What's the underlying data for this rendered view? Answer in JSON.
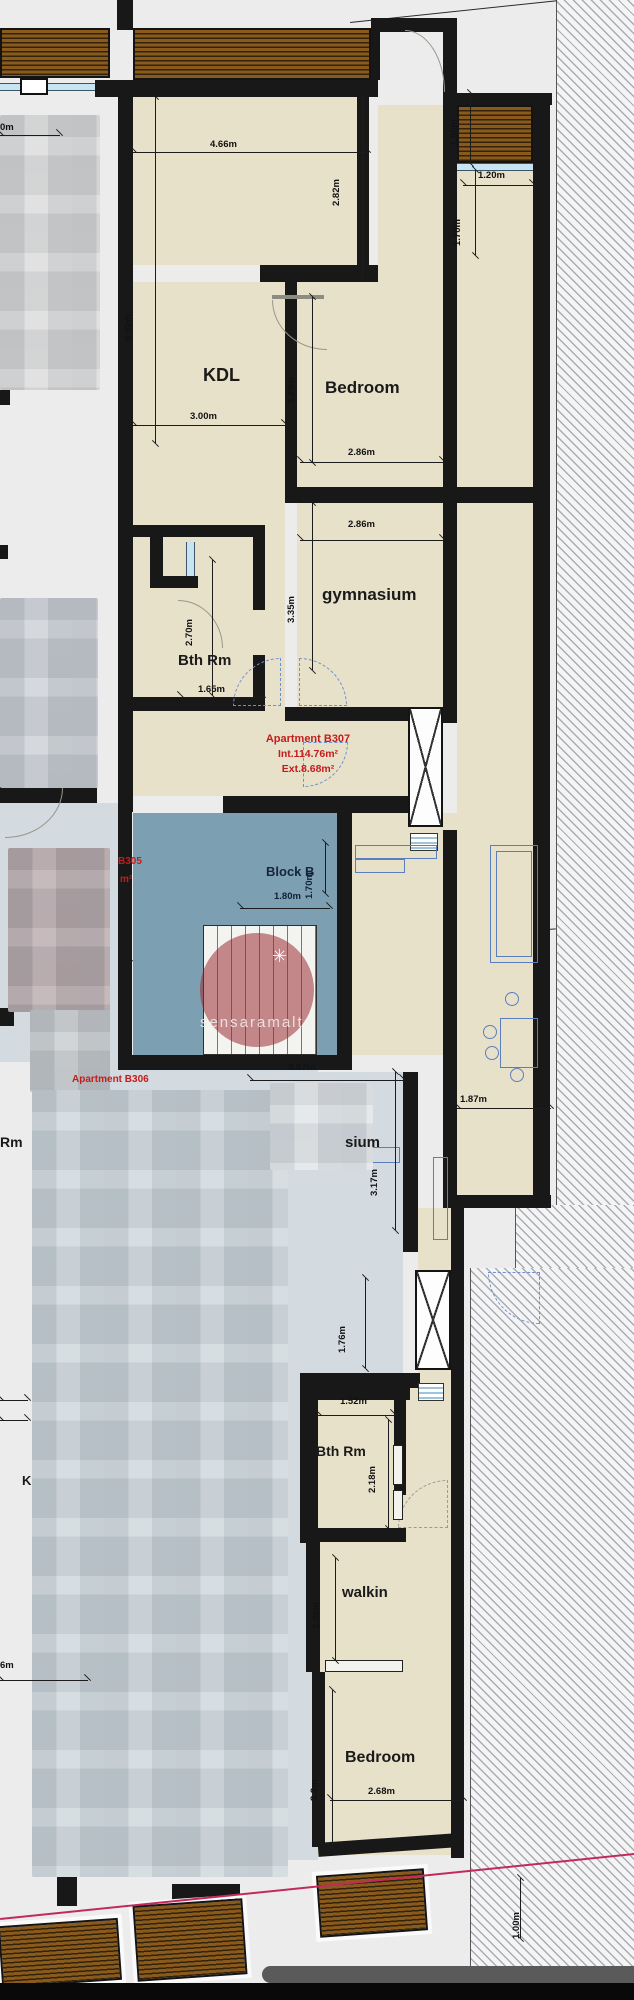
{
  "watermark": {
    "text": "sensaramalta"
  },
  "icons": {
    "watermark_star": "✳"
  },
  "rooms": {
    "kdl": "KDL",
    "bedroom_top": "Bedroom",
    "gymnasium": "gymnasium",
    "bath_top": "Bth Rm",
    "block_b": "Block B",
    "gym_lower_fragment": "sium",
    "bath_lower": "Bth Rm",
    "walkin": "walkin",
    "bedroom_bottom": "Bedroom",
    "left_fragment_rm": "Rm",
    "left_fragment_k": "K"
  },
  "annotations": {
    "b307_title": "Apartment B307",
    "b307_internal": "Int.114.76m²",
    "b307_external": "Ext.8.68m²",
    "b306_title": "Apartment B306",
    "b305_id_fragment": "B305",
    "b305_unit_fragment": "m²"
  },
  "dims": {
    "top_width": "4.66m",
    "balcony_depth": "1.00m",
    "balcony_width": "1.20m",
    "kdl_right_height": "2.82m",
    "nook_height": "1.70m",
    "kdl_height": "6.92m",
    "kdl_width": "3.00m",
    "bedroom_height": "3.29m",
    "bedroom_width": "2.86m",
    "gym_width": "2.86m",
    "gym_height": "3.35m",
    "bath_height": "2.70m",
    "bath_width": "1.65m",
    "stair_depth": "1.70m",
    "stair_width": "1.80m",
    "hall_width": "3.07m",
    "corridor_width": "1.87m",
    "gym2_height": "3.17m",
    "corridor2_height": "1.76m",
    "bath2_width": "1.52m",
    "bath2_height": "2.18m",
    "walkin_depth": "2.00m",
    "bedroom2_height": "3.2m",
    "bedroom2_width": "2.68m",
    "balcony2_depth": "1.00m",
    "edge_top_fragment": "0m",
    "edge_bottom_fragment": "6m"
  },
  "colors": {
    "wall": "#181818",
    "room_fill": "#e8e1ca",
    "stairwell_fill": "#7d9fb2",
    "annotation_red": "#c41c1c",
    "boundary_red": "#c22a5a",
    "deck_brown": "#8a5a1c"
  }
}
